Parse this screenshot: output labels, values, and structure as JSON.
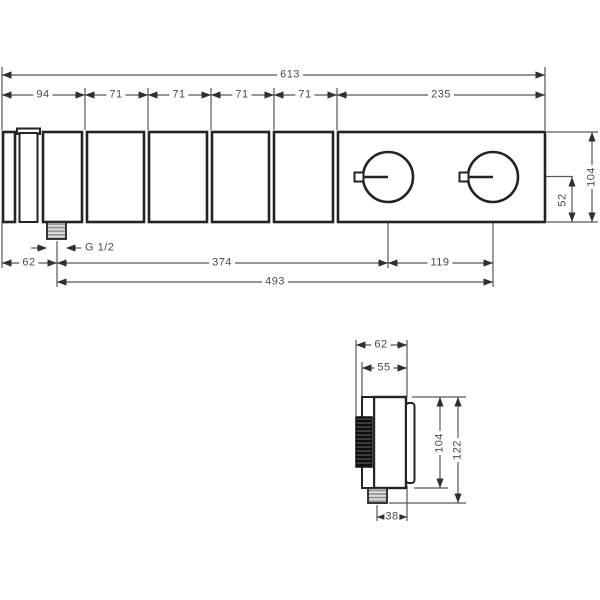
{
  "units": "mm",
  "drawing_kind": "installation dimension drawing, thermostat module with select handles",
  "front_view": {
    "overall_width": "613",
    "segment_widths": [
      "94",
      "71",
      "71",
      "71",
      "71",
      "235"
    ],
    "body_height": "104",
    "handle_center_from_bottom": "52",
    "outlet_thread": "G 1/2",
    "outlet_from_left": "62",
    "outlet_to_first_handle": "374",
    "handle_spacing": "119",
    "outlet_to_second_handle": "493"
  },
  "side_view": {
    "overall_depth": "62",
    "escutcheon_depth": "55",
    "body_height": "104",
    "overall_height": "122",
    "outlet_center_from_wall": "38"
  }
}
